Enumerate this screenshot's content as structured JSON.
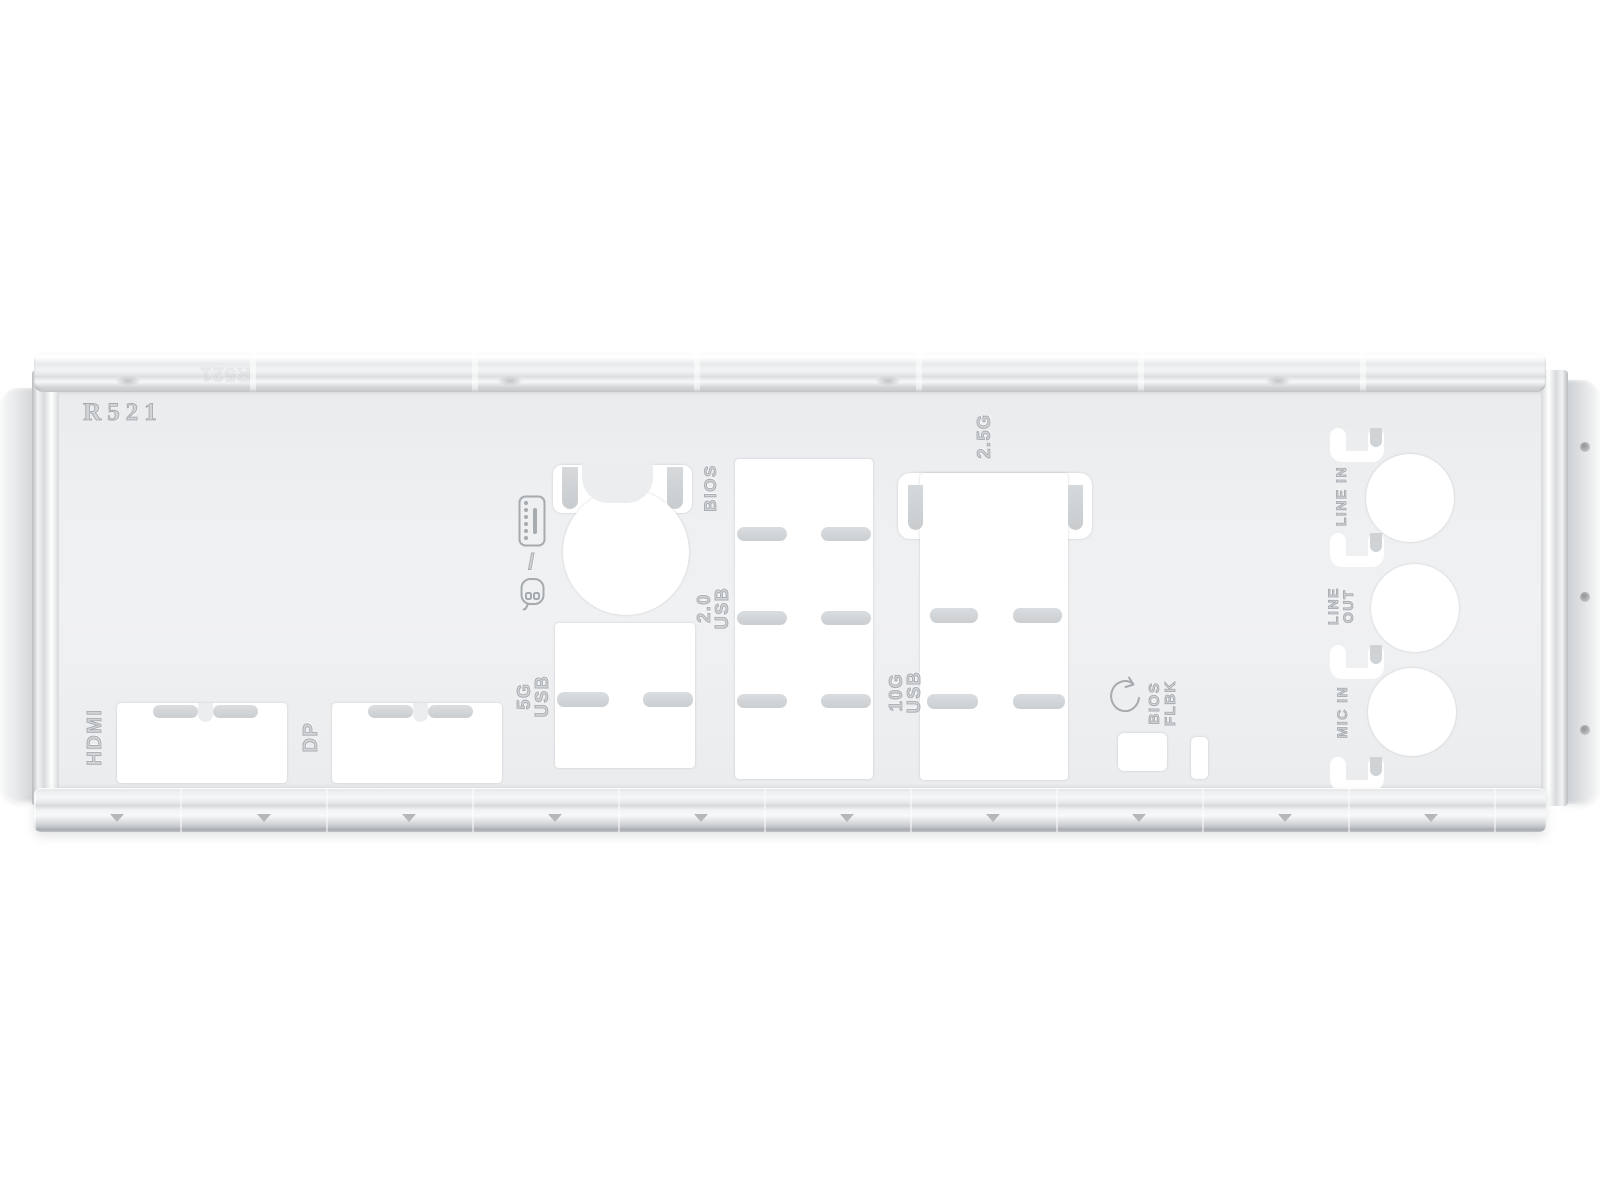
{
  "part": {
    "code": "R521",
    "edge_code": "R521",
    "description": "motherboard rear I/O shield backplate"
  },
  "colors": {
    "background": "#ffffff",
    "plate": "#edeff0",
    "cutout": "#ffffff",
    "finger_tab": "#d0d3d5",
    "engraving": "#a6abaf",
    "edge_shade": "#c8cbce"
  },
  "labels": {
    "hdmi": "HDMI",
    "dp": "DP",
    "usb_5g": "5G\nUSB",
    "usb_20": "2.0\nUSB",
    "bios": "BIOS",
    "usb_10g": "10G\nUSB",
    "lan_25g": "2.5G",
    "bios_flbk": "BIOS\nFLBK",
    "line_in": "LINE IN",
    "line_out": "LINE\nOUT",
    "mic_in": "MIC IN",
    "kb_mouse_separator": "/"
  },
  "icons": {
    "keyboard": "ps2-keyboard-icon",
    "mouse": "ps2-mouse-icon",
    "bios_flashback": "bios-flashback-circular-arrow-icon"
  }
}
